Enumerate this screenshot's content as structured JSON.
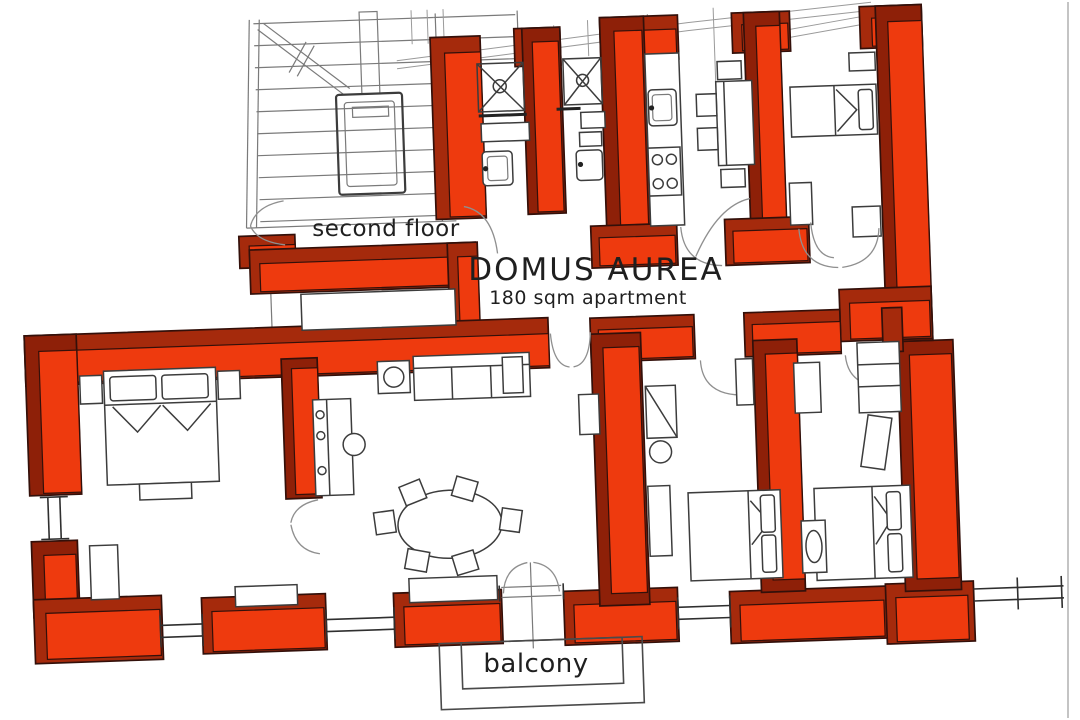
{
  "diagram": {
    "type": "apartment-floor-plan",
    "title": "DOMUS AUREA",
    "subtitle": "180 sqm apartment",
    "labels": {
      "floor": "second floor",
      "balcony": "balcony"
    }
  },
  "colors": {
    "wall_face": "#ee3a0e",
    "wall_top": "#a52a0c",
    "wall_side": "#8e2008",
    "wall_outline": "#33100a",
    "furniture_line": "#3c3c3c",
    "stair_line": "#7a7a7a",
    "window_line": "#2f2f2f",
    "text": "#1f1f1f",
    "background": "#ffffff"
  }
}
